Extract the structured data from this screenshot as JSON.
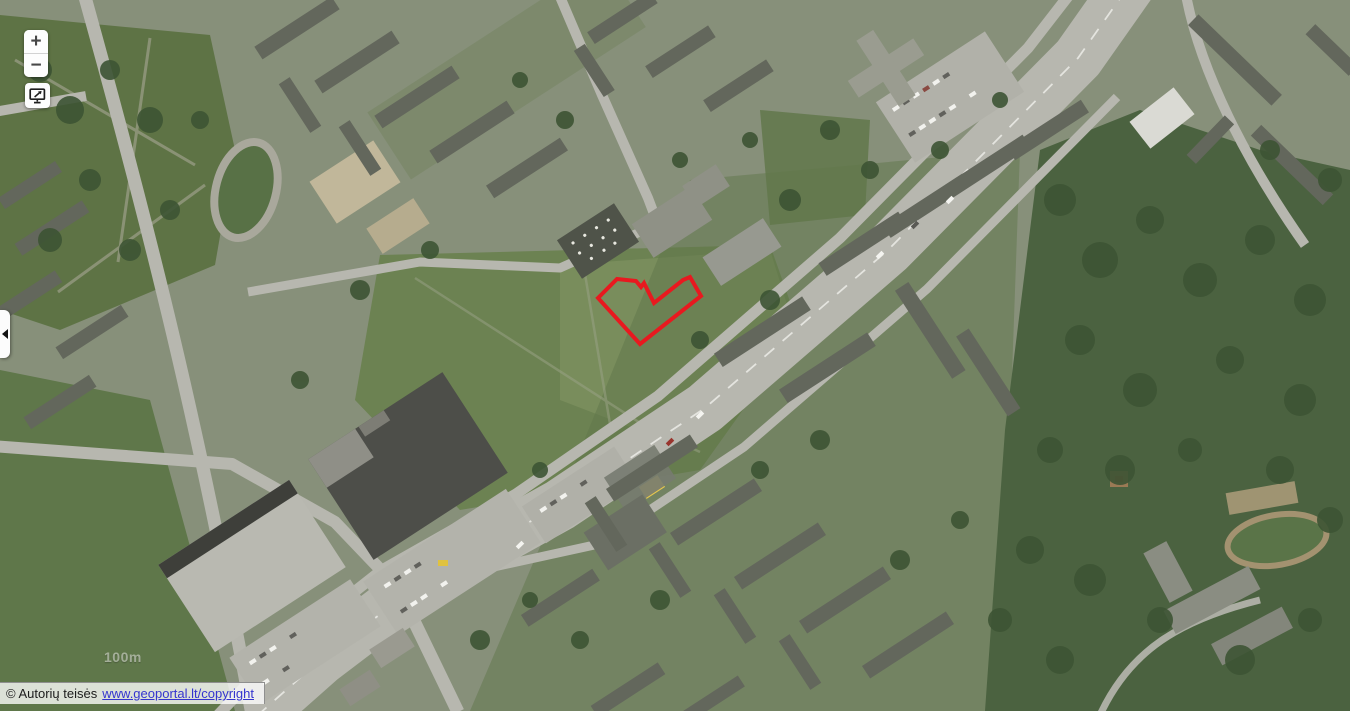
{
  "map": {
    "type": "aerial-orthophoto",
    "scale_label": "100m",
    "parcel": {
      "points": "598,298 617,279 636,281 641,287 644,283 654,303 683,280 690,277 701,296 640,344",
      "outline_color": "#e8191f"
    }
  },
  "controls": {
    "zoom_in": "+",
    "zoom_out": "−",
    "full_extent_icon": "monitor-extent-icon",
    "panel_toggle_icon": "collapse-left-triangle-icon"
  },
  "attribution": {
    "prefix": "© Autorių teisės",
    "link": "www.geoportal.lt/copyright"
  },
  "colors": {
    "parcel_outline": "#e8191f",
    "link": "#3535cf",
    "control_glyph": "#474747",
    "road": "#b7b7af",
    "urban_base": "#87907a",
    "field_green": "#6c8252",
    "forest_green": "#4b6240"
  }
}
